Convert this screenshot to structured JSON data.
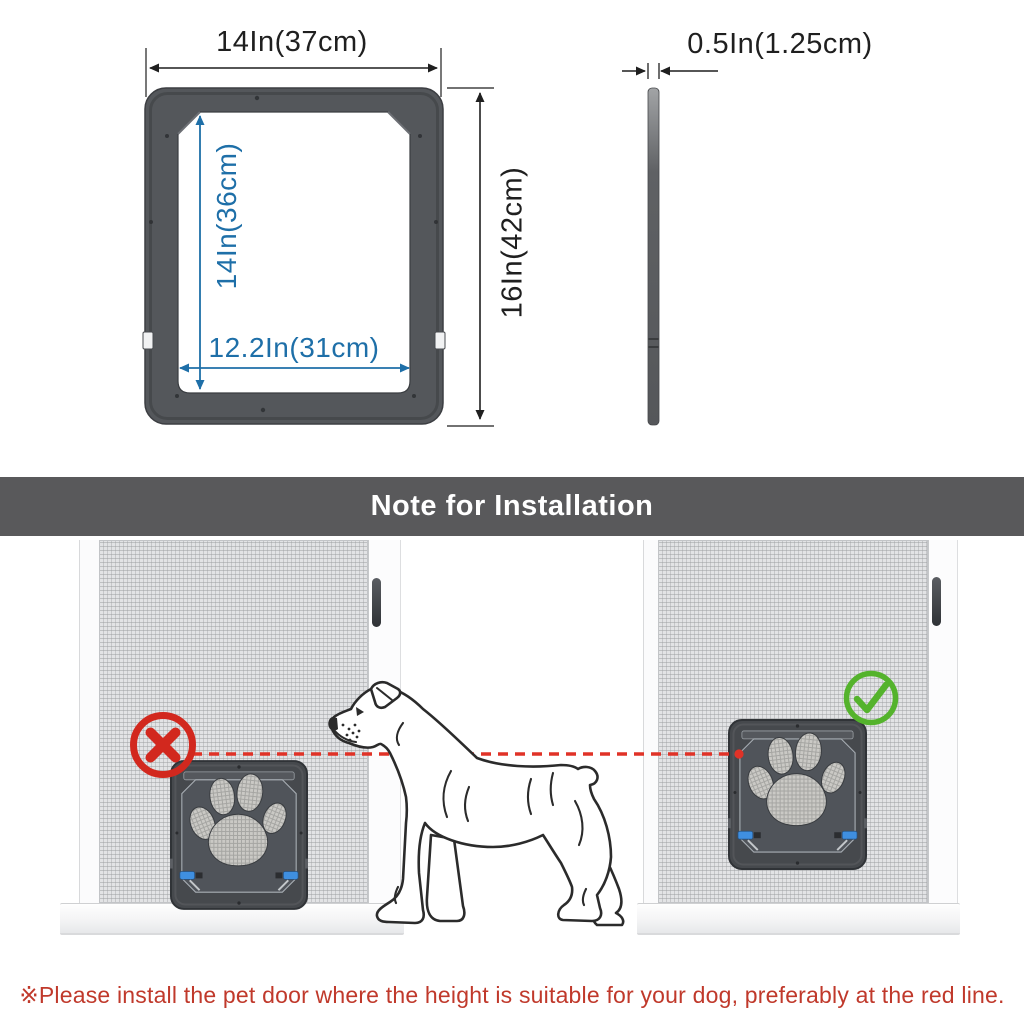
{
  "dimension_diagram": {
    "front_view": {
      "top_width": "14In(37cm)",
      "inner_height": "14In(36cm)",
      "inner_width": "12.2In(31cm)",
      "outer_height": "16In(42cm)"
    },
    "side_view": {
      "thickness": "0.5In(1.25cm)"
    }
  },
  "banner": {
    "title": "Note for Installation"
  },
  "installation_note": {
    "wrong_marker_icon": "x-icon",
    "correct_marker_icon": "check-icon",
    "pet_door_icon": "paw-print-icon",
    "guide_line": "red dashed line at dog head height"
  },
  "footer": {
    "note": "※Please install the pet door where the height is suitable for your dog, preferably at the red line."
  },
  "colors": {
    "dimension_blue": "#1e6fa8",
    "dimension_black": "#1f1f1f",
    "banner_gray": "#59595b",
    "frame_gray": "#54575b",
    "pet_door_gray": "#46494d",
    "error_red": "#d2281e",
    "success_green": "#54b32c",
    "guide_line_red": "#e03227",
    "note_red": "#c0392b"
  }
}
